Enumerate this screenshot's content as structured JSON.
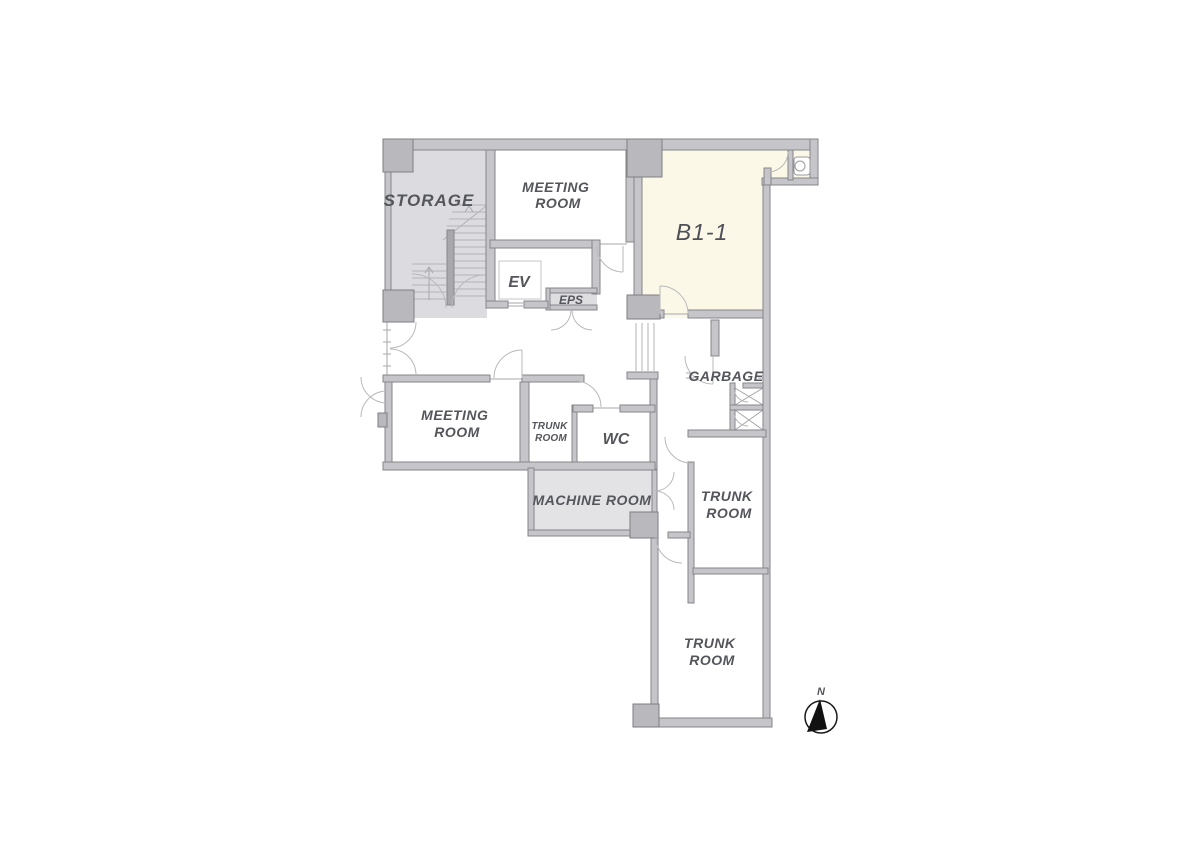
{
  "floor_plan": {
    "rooms": {
      "storage": {
        "label": "STORAGE"
      },
      "meeting_room_top": {
        "line1": "MEETING",
        "line2": "ROOM"
      },
      "unit_b1_1": {
        "label": "B1-1"
      },
      "elevator": {
        "label": "EV"
      },
      "eps": {
        "label": "EPS"
      },
      "meeting_room_lower": {
        "line1": "MEETING",
        "line2": "ROOM"
      },
      "trunk_room_small": {
        "line1": "TRUNK",
        "line2": "ROOM"
      },
      "wc": {
        "label": "WC"
      },
      "machine_room": {
        "label": "MACHINE ROOM"
      },
      "garbage": {
        "label": "GARBAGE"
      },
      "trunk_room_middle": {
        "line1": "TRUNK",
        "line2": "ROOM"
      },
      "trunk_room_bottom": {
        "line1": "TRUNK",
        "line2": "ROOM"
      }
    },
    "compass": {
      "label": "N"
    },
    "colors": {
      "wall": "#c6c6ca",
      "wall_outline": "#86868b",
      "pillar": "#b9b9bd",
      "room_gray_fill": "#dcdce0",
      "machine_room_fill": "#e3e3e5",
      "unit_cream_fill": "#fbf8e8",
      "label_text": "#54565c",
      "compass_black": "#111111"
    }
  }
}
